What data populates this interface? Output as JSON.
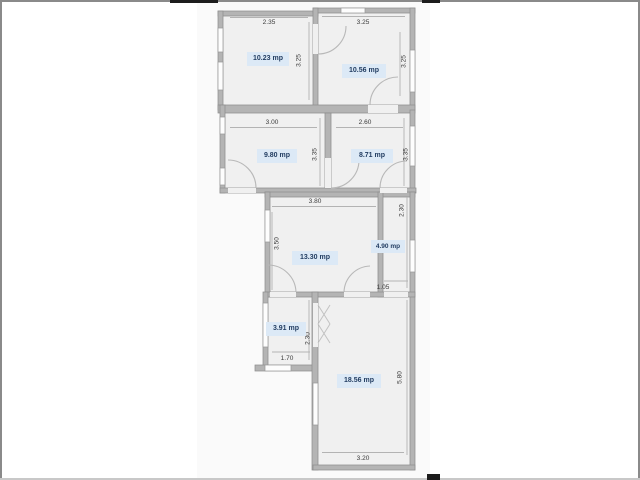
{
  "plan": {
    "unit": "mp",
    "colors": {
      "area_label_bg": "#dce9f6",
      "area_label_text": "#1f3a5f",
      "wall": "#b4b4b4",
      "room_fill": "#f0f0f0",
      "panel_bg": "#fafafa"
    },
    "rooms": [
      {
        "id": "room-top-left",
        "area_label": "10.23 mp",
        "top_dim": "2.35",
        "right_dim": "3.25"
      },
      {
        "id": "room-top-right",
        "area_label": "10.56 mp",
        "top_dim": "3.25",
        "right_dim": "3.25"
      },
      {
        "id": "room-mid-left",
        "area_label": "9.80 mp",
        "top_dim": "3.00",
        "right_dim": "3.35"
      },
      {
        "id": "room-mid-right",
        "area_label": "8.71 mp",
        "top_dim": "2.60",
        "right_dim": "3.35"
      },
      {
        "id": "room-center",
        "area_label": "13.30 mp",
        "top_dim": "3.80",
        "left_dim": "3.50"
      },
      {
        "id": "room-small-right",
        "area_label": "4.90 mp",
        "right_dim": "2.30",
        "bottom_dim": "1.05"
      },
      {
        "id": "room-small-left",
        "area_label": "3.91 mp",
        "right_dim": "2.30",
        "bottom_dim": "1.70"
      },
      {
        "id": "room-bottom-large",
        "area_label": "18.56 mp",
        "right_dim": "5.80",
        "bottom_dim": "3.20"
      }
    ]
  }
}
